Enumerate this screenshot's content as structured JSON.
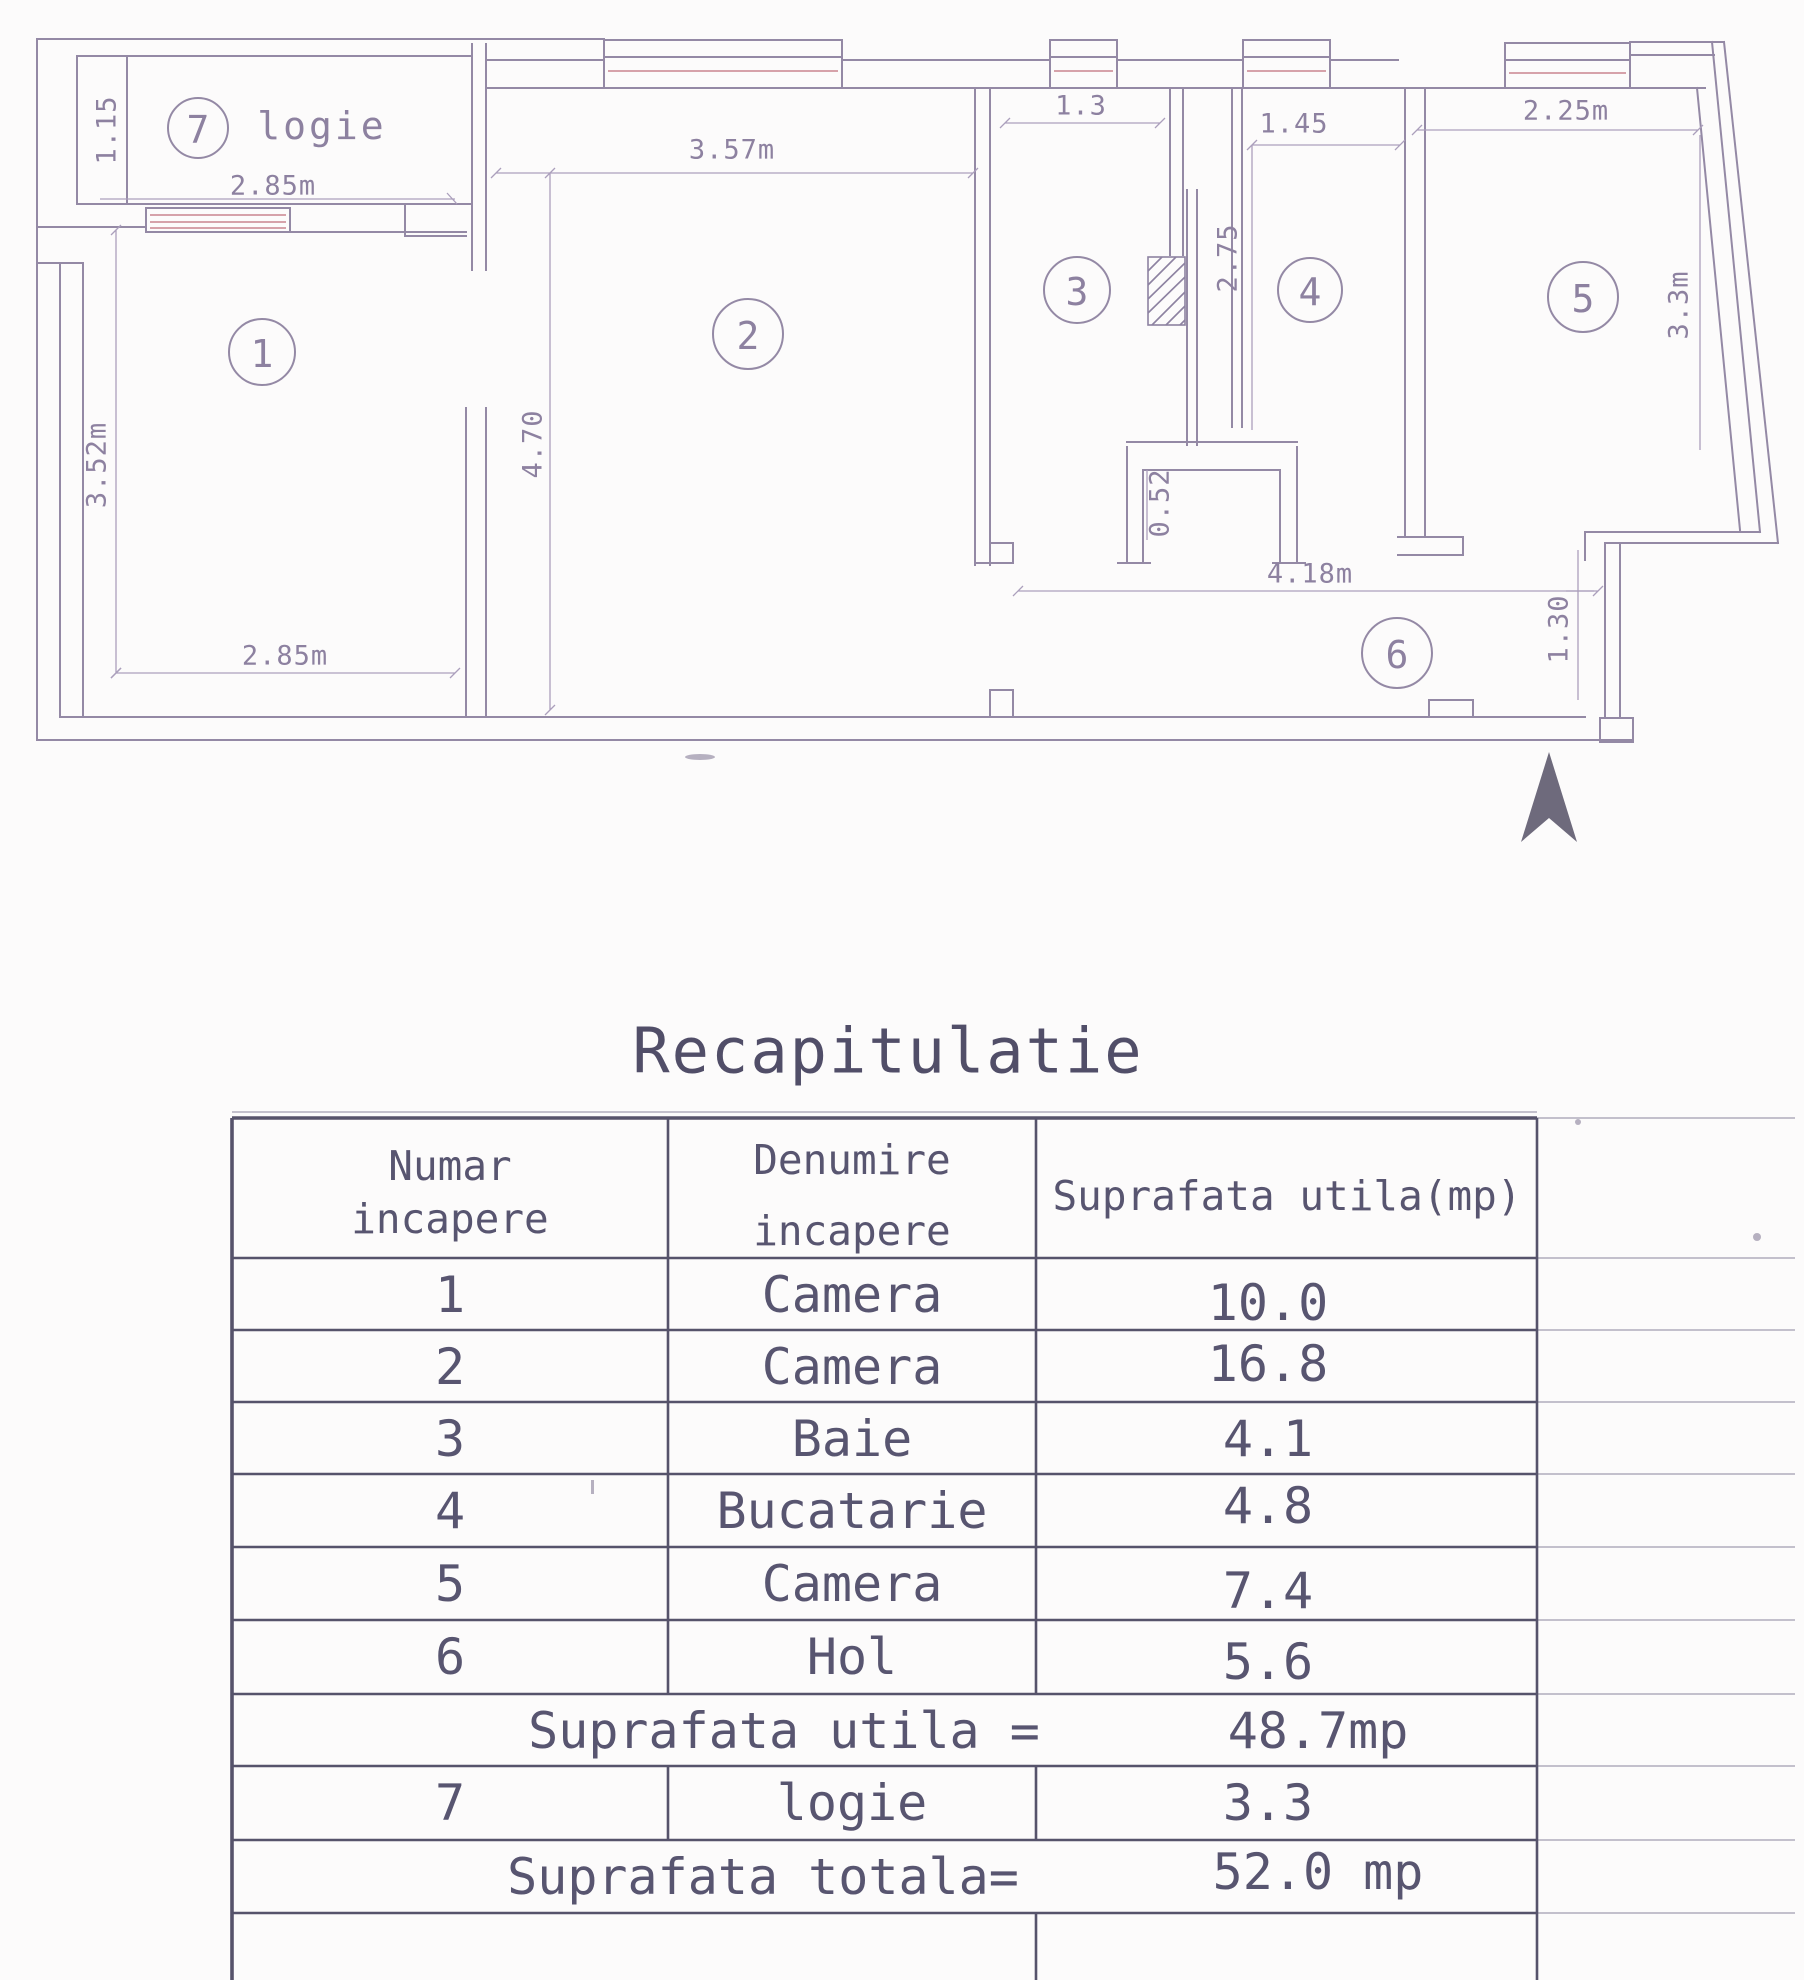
{
  "plan": {
    "loggia_label": "logie",
    "rooms": [
      {
        "number": "1"
      },
      {
        "number": "2"
      },
      {
        "number": "3"
      },
      {
        "number": "4"
      },
      {
        "number": "5"
      },
      {
        "number": "6"
      },
      {
        "number": "7"
      }
    ],
    "dims": {
      "loggia_width": "2.85m",
      "loggia_depth": "1.15",
      "room1_height": "3.52m",
      "room1_width": "2.85m",
      "room2_width": "3.57m",
      "room2_height": "4.70",
      "room3_width": "1.3",
      "room4_width": "1.45",
      "room4_height": "2.75",
      "niche_depth": "0.52",
      "room5_width": "2.25m",
      "room5_height": "3.3m",
      "hall_width": "4.18m",
      "entry_offset": "1.30"
    }
  },
  "table": {
    "title": "Recapitulatie",
    "headers": {
      "col1_line1": "Numar",
      "col1_line2": "incapere",
      "col2_line1": "Denumire",
      "col2_line2": "incapere",
      "col3": "Suprafata utila(mp)"
    },
    "rows": [
      {
        "no": "1",
        "name": "Camera",
        "area": "10.0"
      },
      {
        "no": "2",
        "name": "Camera",
        "area": "16.8"
      },
      {
        "no": "3",
        "name": "Baie",
        "area": "4.1"
      },
      {
        "no": "4",
        "name": "Bucatarie",
        "area": "4.8"
      },
      {
        "no": "5",
        "name": "Camera",
        "area": "7.4"
      },
      {
        "no": "6",
        "name": "Hol",
        "area": "5.6"
      }
    ],
    "subtotal": {
      "label": "Suprafata utila =",
      "value": "48.7mp"
    },
    "row7": {
      "no": "7",
      "name": "logie",
      "area": "3.3"
    },
    "total": {
      "label": "Suprafata totala=",
      "value": "52.0 mp"
    }
  },
  "colors": {
    "plan_line": "#9489a5",
    "plan_text": "#8d81a0",
    "window_accent": "#c9858f",
    "table_line": "#56536b",
    "table_text": "#585570",
    "north_arrow": "#6e6a7c"
  }
}
